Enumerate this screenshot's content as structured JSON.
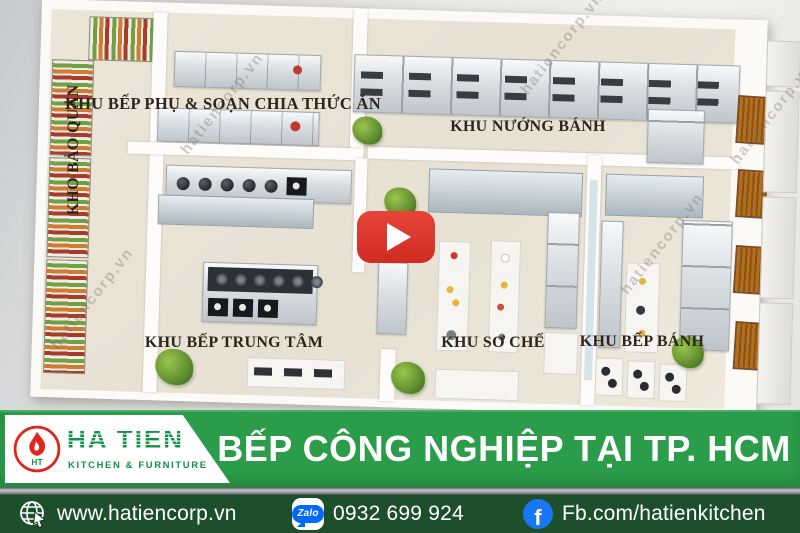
{
  "plan": {
    "room_labels": {
      "storage": "KHO BẢO QUẢN",
      "prep_serving_kitchen": "KHU BẾP PHỤ & SOẠN CHIA THỨC ĂN",
      "baking_area": "KHU NƯỚNG BÁNH",
      "central_kitchen": "KHU BẾP TRUNG TÂM",
      "preprocessing_area": "KHU SƠ CHẾ",
      "pastry_kitchen": "KHU BẾP BÁNH"
    },
    "watermark_text": "hatiencorp.vn"
  },
  "banner": {
    "title": "BẾP CÔNG NGHIỆP TẠI TP. HCM",
    "logo": {
      "brand": "HA TIEN",
      "tagline": "KITCHEN & FURNITURE",
      "monogram": "HT"
    },
    "colors": {
      "banner_green": "#2b9c4a",
      "logo_green": "#0d9447",
      "flame_red": "#e0251c"
    }
  },
  "contact_bar": {
    "website": "www.hatiencorp.vn",
    "phone": "0932 699 924",
    "facebook": "Fb.com/hatienkitchen",
    "zalo_badge": "Zalo",
    "facebook_letter": "f",
    "colors": {
      "bar_green": "#1d4f2c",
      "zalo_blue": "#0168ff",
      "facebook_blue": "#1877f2"
    }
  }
}
